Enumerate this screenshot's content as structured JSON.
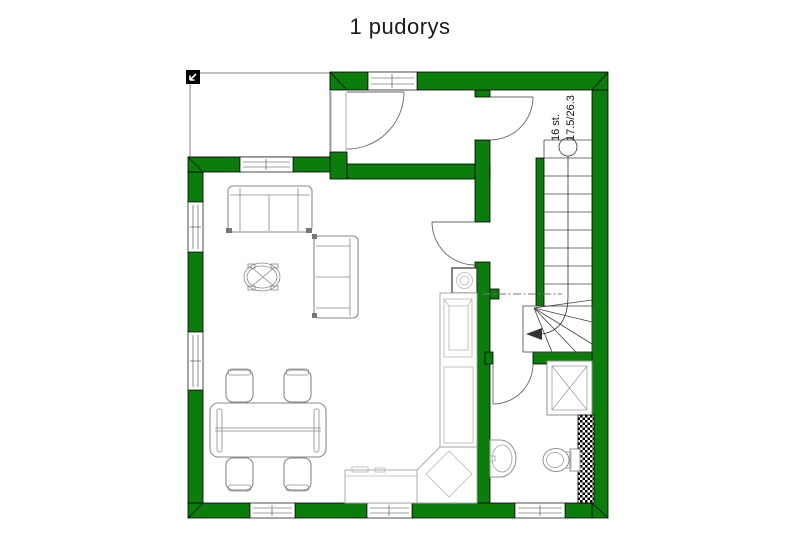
{
  "title": "1 pudorys",
  "plan": {
    "stair_label_steps": "16 st.",
    "stair_label_rise_run": "17.5/26.3"
  },
  "colors": {
    "wall_fill": "#0a7d0a",
    "furniture_line": "#8a8a8a"
  },
  "icons": {
    "north_arrow": "north-arrow-icon"
  }
}
